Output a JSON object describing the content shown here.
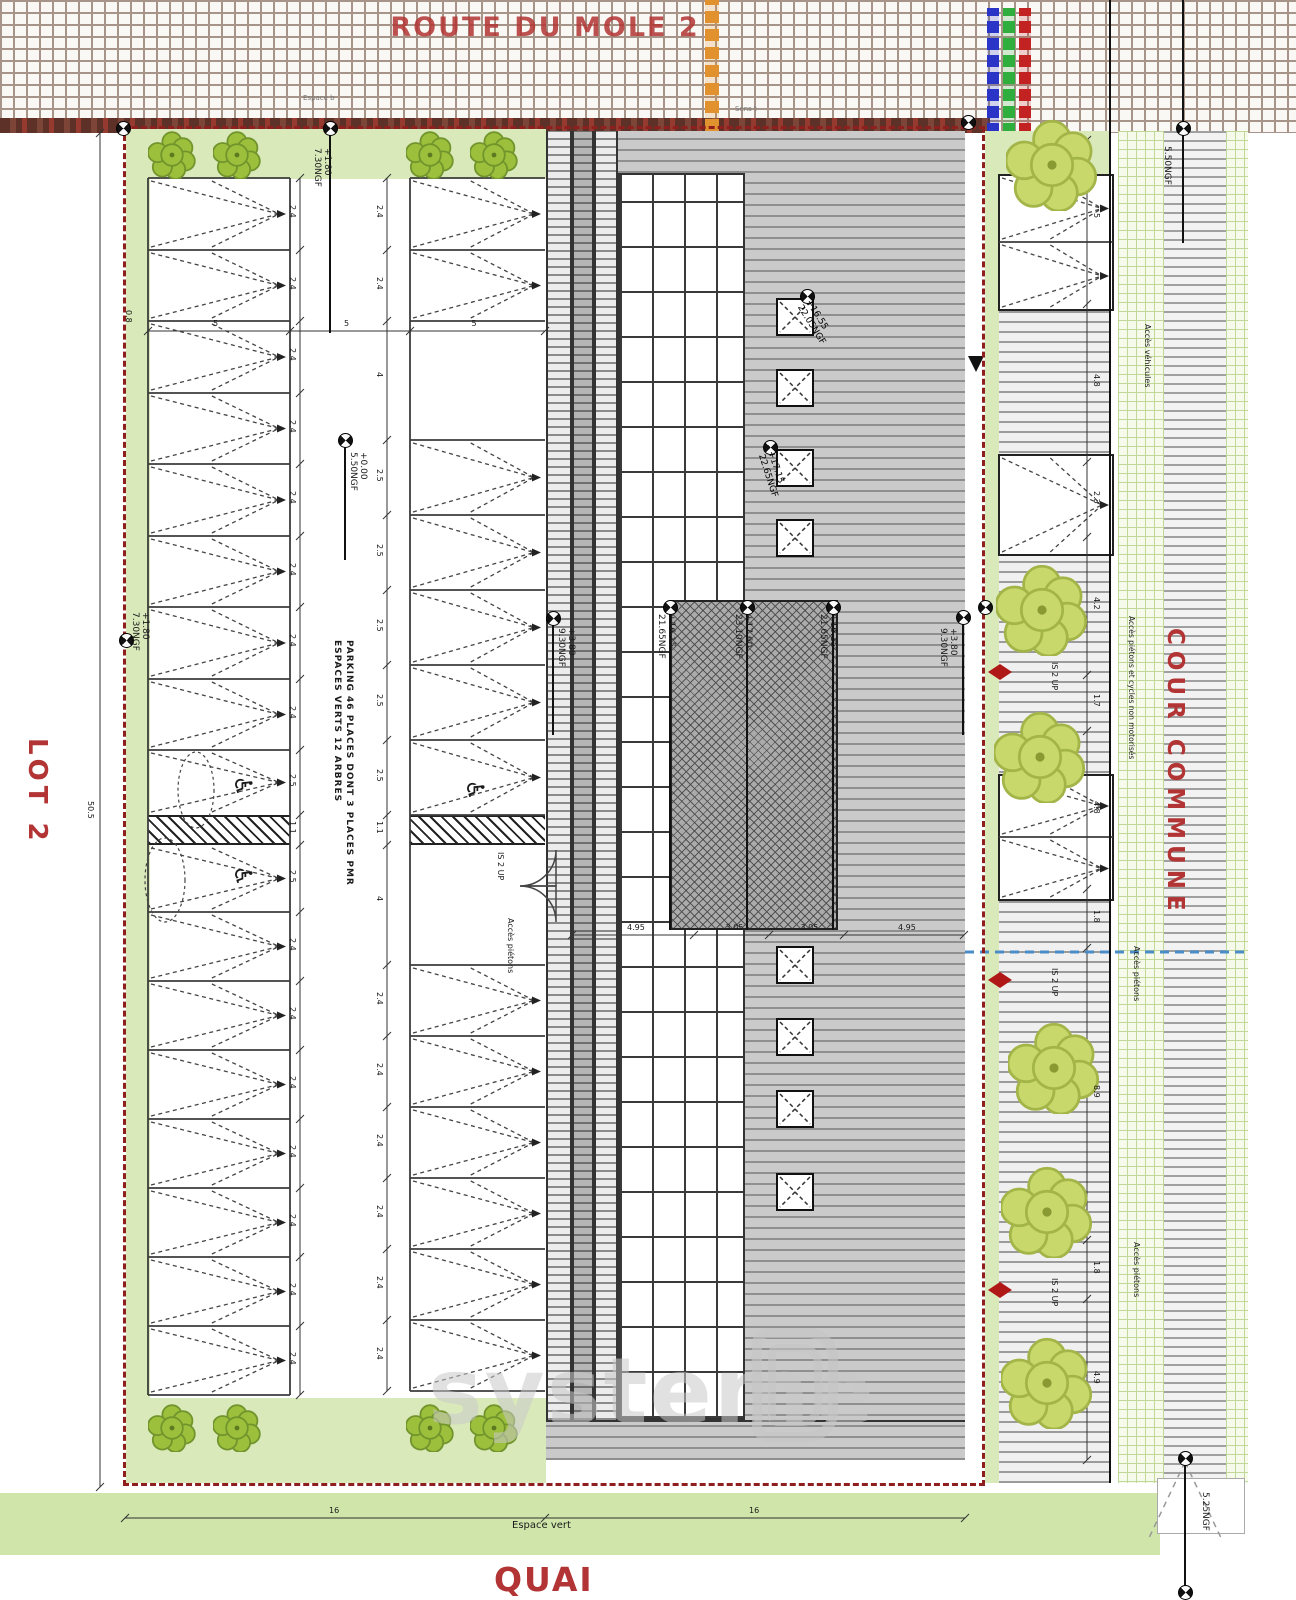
{
  "labels": {
    "route": "ROUTE DU MOLE 2",
    "lot": "LOT 2",
    "cour_commune": "COUR COMMUNE",
    "quai": "QUAI",
    "espace_vert": "Espace vert",
    "top_left_note": "Espace b",
    "top_right_note": "Sens t",
    "parking_line1": "PARKING 46 PLACES DONT 3 PLACES PMR",
    "parking_line2": "ESPACES VERTS 12 ARBRES",
    "acces_pietons": "Accès piétons",
    "acces_vehicules": "Accès véhicules",
    "acces_pietons_cycles": "Accès piétons et cycles non motorisés",
    "is_2_up": "IS 2 UP"
  },
  "icons": {
    "wheelchair": "♿"
  },
  "elevations": {
    "lot_top": {
      "value": "+1.80",
      "ngf": "7.30NGF"
    },
    "lot_center": {
      "value": "+0.00",
      "ngf": "5.50NGF"
    },
    "lot_left": {
      "value": "+1.80",
      "ngf": "7.30NGF"
    },
    "building_left": {
      "value": "+3.80",
      "ngf": "9.30NGF"
    },
    "building_right": {
      "value": "+3.80",
      "ngf": "9.30NGF"
    },
    "skylight_upper": {
      "value": "+16.55",
      "ngf": "22.05NGF"
    },
    "skylight_lower": {
      "value": "+17.15",
      "ngf": "22.65NGF"
    },
    "tower_left": {
      "value": "+16.15",
      "ngf": "21.65NGF"
    },
    "tower_mid": {
      "value": "+17.60",
      "ngf": "23.10NGF"
    },
    "tower_right": {
      "value": "+16.15",
      "ngf": "21.65NGF"
    },
    "court_top": "5.50NGF",
    "quai_corner": "5.25NGF"
  },
  "dimensions": {
    "lot_height": "50.5",
    "espace_vert_width": "16",
    "building_width": "16",
    "edge_offset": "0.8",
    "bay_width_labels": [
      "5",
      "5",
      "5"
    ],
    "roof_segments": [
      "4.95",
      "3.05",
      "3.05",
      "4.95"
    ],
    "aisle_left": [
      "2.4",
      "2.4",
      "2.4",
      "2.4",
      "2.4",
      "2.4",
      "2.4",
      "2.4",
      "2.5",
      "1.1",
      "2.5",
      "2.4",
      "2.4",
      "2.4",
      "2.4",
      "2.4",
      "2.4",
      "2.4"
    ],
    "aisle_right": [
      "2.4",
      "2.4",
      "4",
      "2.5",
      "2.5",
      "2.5",
      "2.5",
      "2.5",
      "1.1",
      "4",
      "2.4",
      "2.4",
      "2.4",
      "2.4",
      "2.4",
      "2.4"
    ],
    "court_segments": [
      "5",
      "4.8",
      "2.3",
      "4.2",
      "1.7",
      "4.8",
      "1.8",
      "8.9",
      "1.8",
      "4.9"
    ]
  },
  "watermark": {
    "text": "systeme",
    "mark": "D"
  },
  "colors": {
    "plan_red": "#b23434",
    "boundary_red": "#8f1f1f",
    "green_strip": "#d9e9ba",
    "tree_green": "#9cc03c",
    "court_tree_green": "#c9d86b",
    "roof_gray": "#cacaca",
    "accent_orange": "#e2912f",
    "legend_blue": "#2a35c8",
    "legend_green": "#2fae3e",
    "legend_red": "#c32222",
    "water_blue": "#4a8cc8"
  }
}
